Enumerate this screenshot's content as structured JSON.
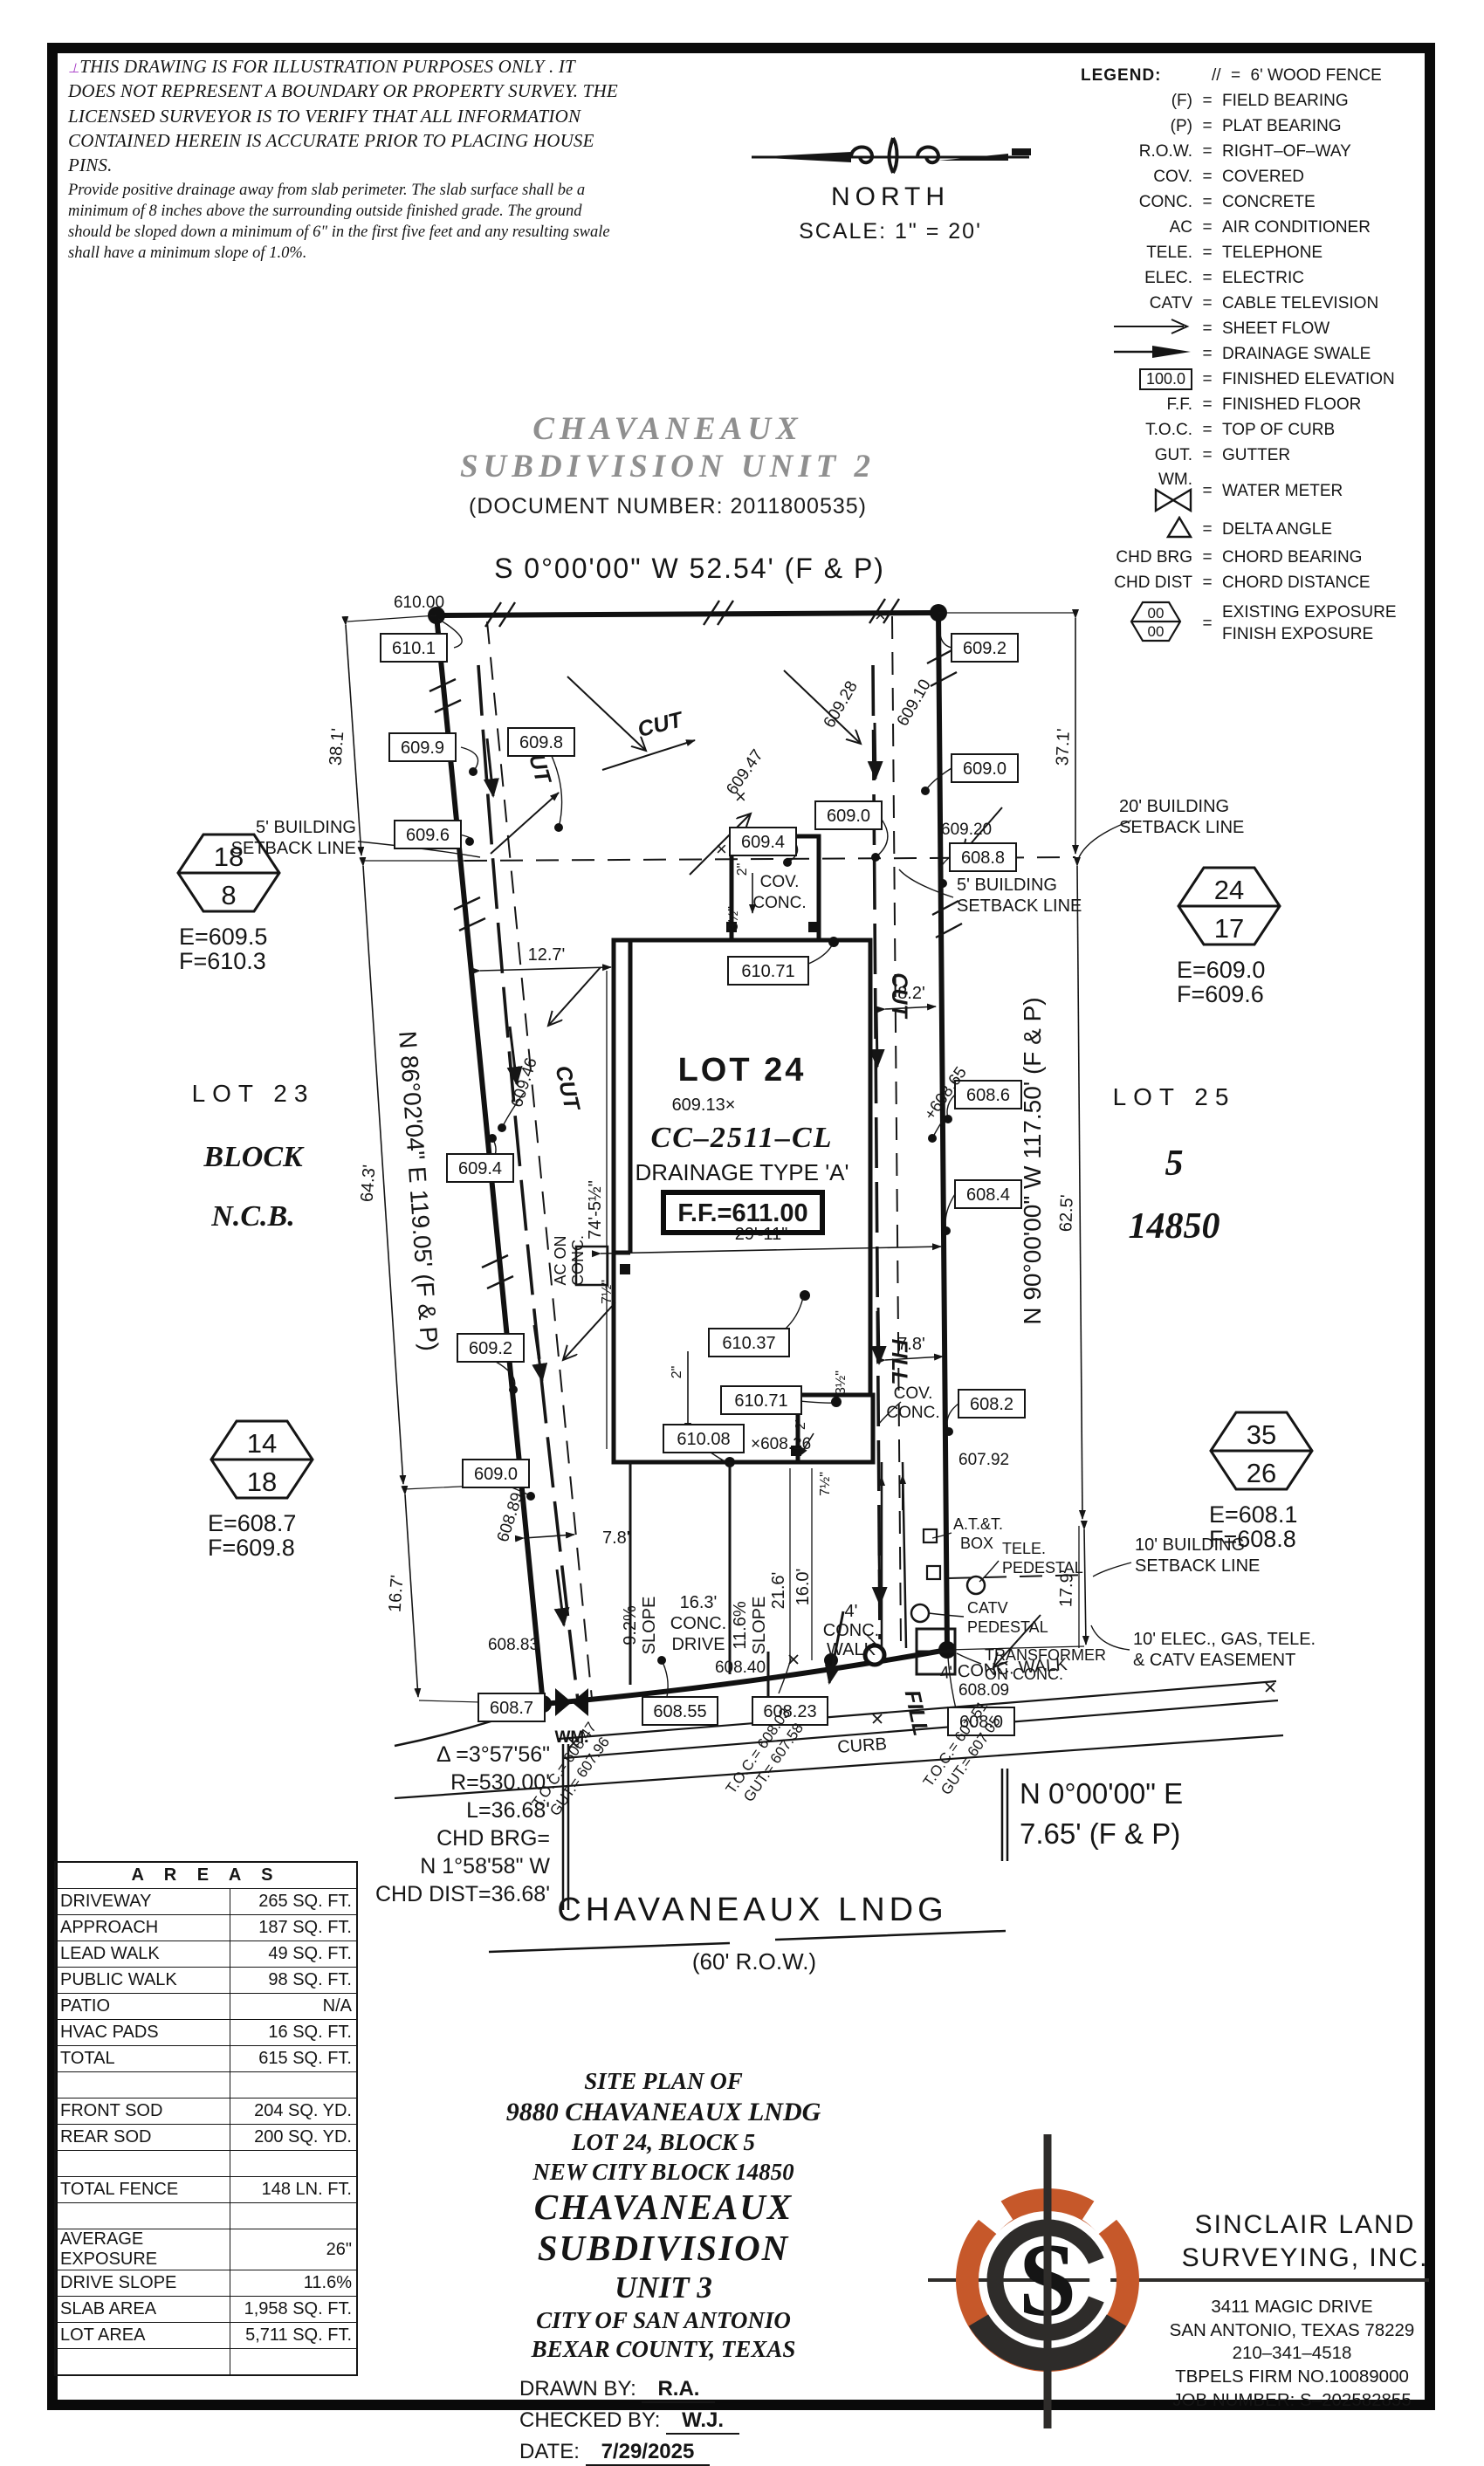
{
  "disclaimer": {
    "mark": "⊥",
    "p1": "THIS DRAWING IS FOR ILLUSTRATION PURPOSES ONLY . IT DOES NOT REPRESENT A BOUNDARY OR PROPERTY SURVEY. THE LICENSED SURVEYOR IS TO VERIFY THAT ALL INFORMATION CONTAINED HEREIN IS ACCURATE PRIOR TO PLACING HOUSE PINS.",
    "p2": "Provide positive drainage away from slab perimeter. The slab surface shall be a minimum of 8 inches above the surrounding outside finished grade. The ground should be sloped down a minimum of 6\" in the first five feet and any resulting swale shall have a minimum slope of 1.0%."
  },
  "north": {
    "label": "NORTH",
    "scale": "SCALE:  1\"  =  20'"
  },
  "legend": {
    "title": "LEGEND:",
    "eq": "=",
    "rows": [
      {
        "sym": "//",
        "desc": "6' WOOD FENCE"
      },
      {
        "sym": "(F)",
        "desc": "FIELD BEARING"
      },
      {
        "sym": "(P)",
        "desc": "PLAT BEARING"
      },
      {
        "sym": "R.O.W.",
        "desc": "RIGHT–OF–WAY"
      },
      {
        "sym": "COV.",
        "desc": "COVERED"
      },
      {
        "sym": "CONC.",
        "desc": "CONCRETE"
      },
      {
        "sym": "AC",
        "desc": "AIR CONDITIONER"
      },
      {
        "sym": "TELE.",
        "desc": "TELEPHONE"
      },
      {
        "sym": "ELEC.",
        "desc": "ELECTRIC"
      },
      {
        "sym": "CATV",
        "desc": "CABLE TELEVISION"
      },
      {
        "sym": "",
        "desc": "SHEET FLOW"
      },
      {
        "sym": "",
        "desc": "DRAINAGE SWALE"
      },
      {
        "sym": "100.0",
        "desc": "FINISHED ELEVATION"
      },
      {
        "sym": "F.F.",
        "desc": "FINISHED FLOOR"
      },
      {
        "sym": "T.O.C.",
        "desc": "TOP OF CURB"
      },
      {
        "sym": "GUT.",
        "desc": "GUTTER"
      },
      {
        "sym": "WM.",
        "desc": "WATER METER"
      },
      {
        "sym": "",
        "desc": "DELTA ANGLE"
      },
      {
        "sym": "CHD BRG",
        "desc": "CHORD BEARING"
      },
      {
        "sym": "CHD DIST",
        "desc": "CHORD DISTANCE"
      },
      {
        "sym": "00",
        "sym2": "00",
        "desc": "EXISTING EXPOSURE",
        "desc2": "FINISH EXPOSURE"
      }
    ]
  },
  "subdivision2": {
    "line1": "CHAVANEAUX",
    "line2": "SUBDIVISION  UNIT  2",
    "doc": "(DOCUMENT NUMBER:  2011800535)"
  },
  "plat": {
    "bearing_top": "S 0°00'00\" W 52.54' (F & P)",
    "bearing_left": "N 86°02'04\" E 119.05' (F & P)",
    "bearing_right": "N 90°00'00\" W 117.50' (F & P)",
    "bearing_se1": "N 0°00'00\" E",
    "bearing_se2": "7.65' (F & P)",
    "lot23": {
      "name": "LOT 23",
      "block": "BLOCK",
      "ncb": "N.C.B."
    },
    "lot24": {
      "name": "LOT 24",
      "spot": "609.13×",
      "plan": "CC–2511–CL",
      "drainage": "DRAINAGE TYPE 'A'",
      "ff": "F.F.=611.00"
    },
    "lot25": {
      "name": "LOT 25",
      "block": "5",
      "ncb": "14850"
    },
    "hex_nw": {
      "top": "18",
      "bot": "8",
      "e": "E=609.5",
      "f": "F=610.3"
    },
    "hex_ne": {
      "top": "24",
      "bot": "17",
      "e": "E=609.0",
      "f": "F=609.6"
    },
    "hex_sw": {
      "top": "14",
      "bot": "18",
      "e": "E=608.7",
      "f": "F=609.8"
    },
    "hex_se": {
      "top": "35",
      "bot": "26",
      "e": "E=608.1",
      "f": "F=608.8"
    },
    "setbacks": {
      "s5a": "5' BUILDING",
      "s5b": "SETBACK LINE",
      "s20a": "20' BUILDING",
      "s20b": "SETBACK LINE",
      "s10a": "10' BUILDING",
      "s10b": "SETBACK LINE",
      "easea": "10' ELEC., GAS, TELE.",
      "easeb": "& CATV EASEMENT"
    },
    "boxes": {
      "b610_1": "610.1",
      "b609_9": "609.9",
      "b609_8": "609.8",
      "b609_6": "609.6",
      "b609_4t": "609.4",
      "b609_0t": "609.0",
      "b609_2r": "609.2",
      "b609_0r": "609.0",
      "b608_8": "608.8",
      "b608_6": "608.6",
      "b608_4": "608.4",
      "b608_2": "608.2",
      "b608_0": "608.0",
      "b609_4l": "609.4",
      "b609_2l": "609.2",
      "b609_0l": "609.0",
      "b610_71t": "610.71",
      "b610_37": "610.37",
      "b610_71b": "610.71",
      "b610_08": "610.08",
      "b608_7": "608.7",
      "b608_55": "608.55",
      "b608_23": "608.23"
    },
    "spots": {
      "s610_00": "610.00",
      "s609_28": "609.28",
      "s609_10": "609.10",
      "s609_47": "609.47",
      "s609_20": "609.20",
      "s609_46": "609.46",
      "s608_89": "608.89",
      "s608_65": "+608.65",
      "s608_83": "608.83",
      "s608_40": "608.40",
      "s608_26": "×608.26",
      "s608_09": "608.09",
      "s607_92": "607.92",
      "xmark": "×"
    },
    "dims": {
      "d38_1": "38.1'",
      "d64_3": "64.3'",
      "d16_7": "16.7'",
      "d37_1": "37.1'",
      "d62_5": "62.5'",
      "d17_9": "17.9'",
      "d12_7": "12.7'",
      "d8_2": "8.2'",
      "d7_8": "7.8'",
      "d74": "74'-5½\"",
      "d29": "29'-11\"",
      "d2in": "2\"",
      "d3h": "3½\"",
      "d7h": "7½\"",
      "d2ft": "2'",
      "d21_6": "21.6'",
      "d16_0": "16.0'",
      "drv1": "16.3'",
      "drv2": "CONC.",
      "drv3": "DRIVE",
      "sl1a": "9.2%",
      "sl1b": "SLOPE",
      "sl2a": "11.6%",
      "sl2b": "SLOPE",
      "walk1": "4' CONC. WALK",
      "walk2a": "4'",
      "walk2b": "CONC.",
      "walk2c": "WALK"
    },
    "labels": {
      "cut": "CUT",
      "fill": "FILL",
      "ac1": "AC ON",
      "ac2": "CONC.",
      "cov1": "COV.",
      "cov2": "CONC.",
      "wm": "WM.",
      "att1": "A.T.&T.",
      "att2": "BOX",
      "tele1": "TELE.",
      "tele2": "PEDESTAL",
      "catv1": "CATV",
      "catv2": "PEDESTAL",
      "tr1": "TRANSFORMER",
      "tr2": "ON CONC.",
      "curb": "CURB"
    },
    "toc": {
      "t1a": "T.O.C.= 608.47",
      "t1b": "GUT.= 607.96",
      "t2a": "T.O.C.= 608.03",
      "t2b": "GUT.= 607.58",
      "t3a": "T.O.C.= 607.51",
      "t3b": "GUT.= 607.05"
    },
    "curve": {
      "l1": "Δ =3°57'56\"",
      "l2": "R=530.00'",
      "l3": "L=36.68'",
      "l4": "CHD BRG=",
      "l5": "N 1°58'58\" W",
      "l6": "CHD DIST=36.68'"
    },
    "street": {
      "name": "CHAVANEAUX LNDG",
      "row": "(60' R.O.W.)"
    }
  },
  "areas": {
    "title": "A R E A S",
    "rows": [
      {
        "n": "DRIVEWAY",
        "v": "265 SQ. FT."
      },
      {
        "n": "APPROACH",
        "v": "187 SQ. FT."
      },
      {
        "n": "LEAD WALK",
        "v": "49 SQ. FT."
      },
      {
        "n": "PUBLIC WALK",
        "v": "98 SQ. FT."
      },
      {
        "n": "PATIO",
        "v": "N/A"
      },
      {
        "n": "HVAC PADS",
        "v": "16 SQ. FT."
      },
      {
        "n": "TOTAL",
        "v": "615 SQ. FT."
      },
      {
        "n": "",
        "v": ""
      },
      {
        "n": "FRONT SOD",
        "v": "204 SQ. YD."
      },
      {
        "n": "REAR SOD",
        "v": "200 SQ. YD."
      },
      {
        "n": "",
        "v": ""
      },
      {
        "n": "TOTAL FENCE",
        "v": "148  LN. FT."
      },
      {
        "n": "",
        "v": ""
      },
      {
        "n": "AVERAGE EXPOSURE",
        "v": "26\""
      },
      {
        "n": "DRIVE SLOPE",
        "v": "11.6%"
      },
      {
        "n": "SLAB AREA",
        "v": "1,958 SQ. FT."
      },
      {
        "n": "LOT AREA",
        "v": "5,711 SQ. FT."
      },
      {
        "n": "",
        "v": ""
      }
    ]
  },
  "titleblock": {
    "l1": "SITE  PLAN  OF",
    "l2": "9880  CHAVANEAUX  LNDG",
    "l3": "LOT  24,  BLOCK  5",
    "l4": "NEW  CITY  BLOCK  14850",
    "l5": "CHAVANEAUX  SUBDIVISION",
    "l6": "UNIT  3",
    "l7": "CITY  OF  SAN  ANTONIO",
    "l8": "BEXAR  COUNTY,  TEXAS",
    "drawn_label": "DRAWN  BY:",
    "drawn": "R.A.",
    "checked_label": "CHECKED  BY:",
    "checked": "W.J.",
    "date_label": "DATE:",
    "date": "7/29/2025"
  },
  "firm": {
    "name1": "SINCLAIR  LAND",
    "name2": "SURVEYING,  INC.",
    "logo_s": "S",
    "addr1": "3411  MAGIC  DRIVE",
    "addr2": "SAN  ANTONIO,  TEXAS  78229",
    "phone": "210–341–4518",
    "firm_no": "TBPELS  FIRM  NO.10089000",
    "job": "JOB  NUMBER: S–202582855"
  },
  "colors": {
    "ink": "#151515",
    "gray_title": "#8f8f8f",
    "logo_orange": "#c6582a",
    "logo_dark": "#2e2c2a"
  }
}
